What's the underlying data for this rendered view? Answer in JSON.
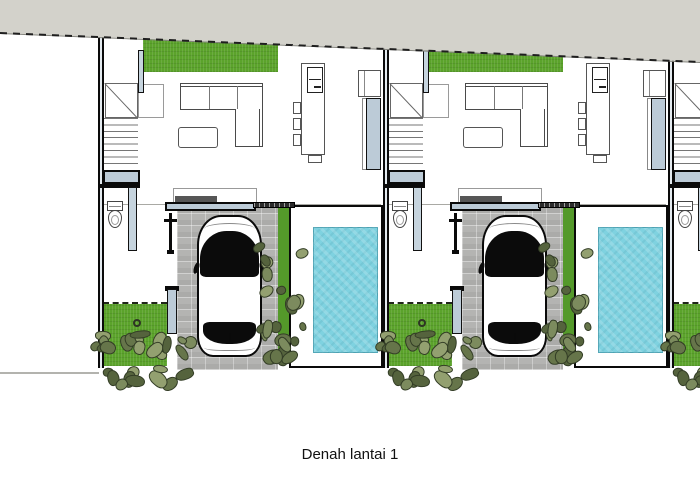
{
  "caption": "Denah lantai 1",
  "plan": {
    "type": "architectural-floor-plan",
    "description": "Row of identical two-storey townhouse units, ground floor plan with living room, kitchen island, stairs, toilet, carport with car, planting strips and swimming pool",
    "units": [
      {
        "x": 98
      },
      {
        "x": 383
      },
      {
        "x": 668
      }
    ],
    "colors": {
      "grass": "#5ba32b",
      "grass2": "#54992a",
      "pool": "#7fd2e0",
      "road": "#d3d2cb",
      "plate": "#bccbd7",
      "paver": "#b4b4b2"
    },
    "bush_tones": [
      "#93a070",
      "#7c8b5e",
      "#66754a",
      "#55633d"
    ]
  }
}
